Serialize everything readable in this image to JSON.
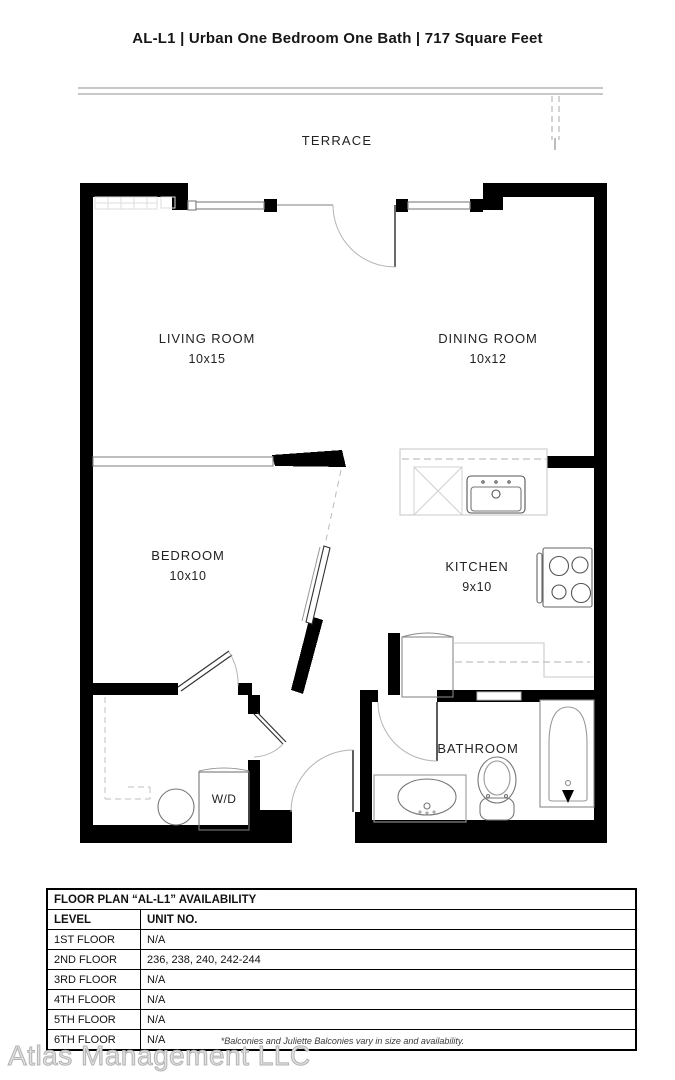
{
  "header": {
    "title": "AL-L1 | Urban One Bedroom One Bath | 717 Square Feet"
  },
  "floor_plan": {
    "terrace": {
      "name": "TERRACE"
    },
    "rooms": {
      "living": {
        "name": "LIVING ROOM",
        "dims": "10x15"
      },
      "dining": {
        "name": "DINING ROOM",
        "dims": "10x12"
      },
      "bedroom": {
        "name": "BEDROOM",
        "dims": "10x10"
      },
      "kitchen": {
        "name": "KITCHEN",
        "dims": "9x10"
      },
      "bathroom": {
        "name": "BATHROOM"
      },
      "laundry": {
        "name": "W/D"
      }
    }
  },
  "availability_table": {
    "title": "FLOOR PLAN “AL-L1” AVAILABILITY",
    "columns": [
      "LEVEL",
      "UNIT NO."
    ],
    "rows": [
      {
        "level": "1ST FLOOR",
        "units": "N/A"
      },
      {
        "level": "2ND FLOOR",
        "units": "236, 238, 240, 242-244"
      },
      {
        "level": "3RD FLOOR",
        "units": "N/A"
      },
      {
        "level": "4TH FLOOR",
        "units": "N/A"
      },
      {
        "level": "5TH FLOOR",
        "units": "N/A"
      },
      {
        "level": "6TH FLOOR",
        "units": "N/A"
      }
    ]
  },
  "footnote": "*Balconies and Juliette Balconies vary in size and availability.",
  "watermark": "Atlas Management LLC",
  "colors": {
    "wall": "#000000",
    "counter": "#c9c9c9",
    "dashed": "#c0c0c0",
    "fixture": "#777777",
    "watermark": "#c4c4c4"
  }
}
